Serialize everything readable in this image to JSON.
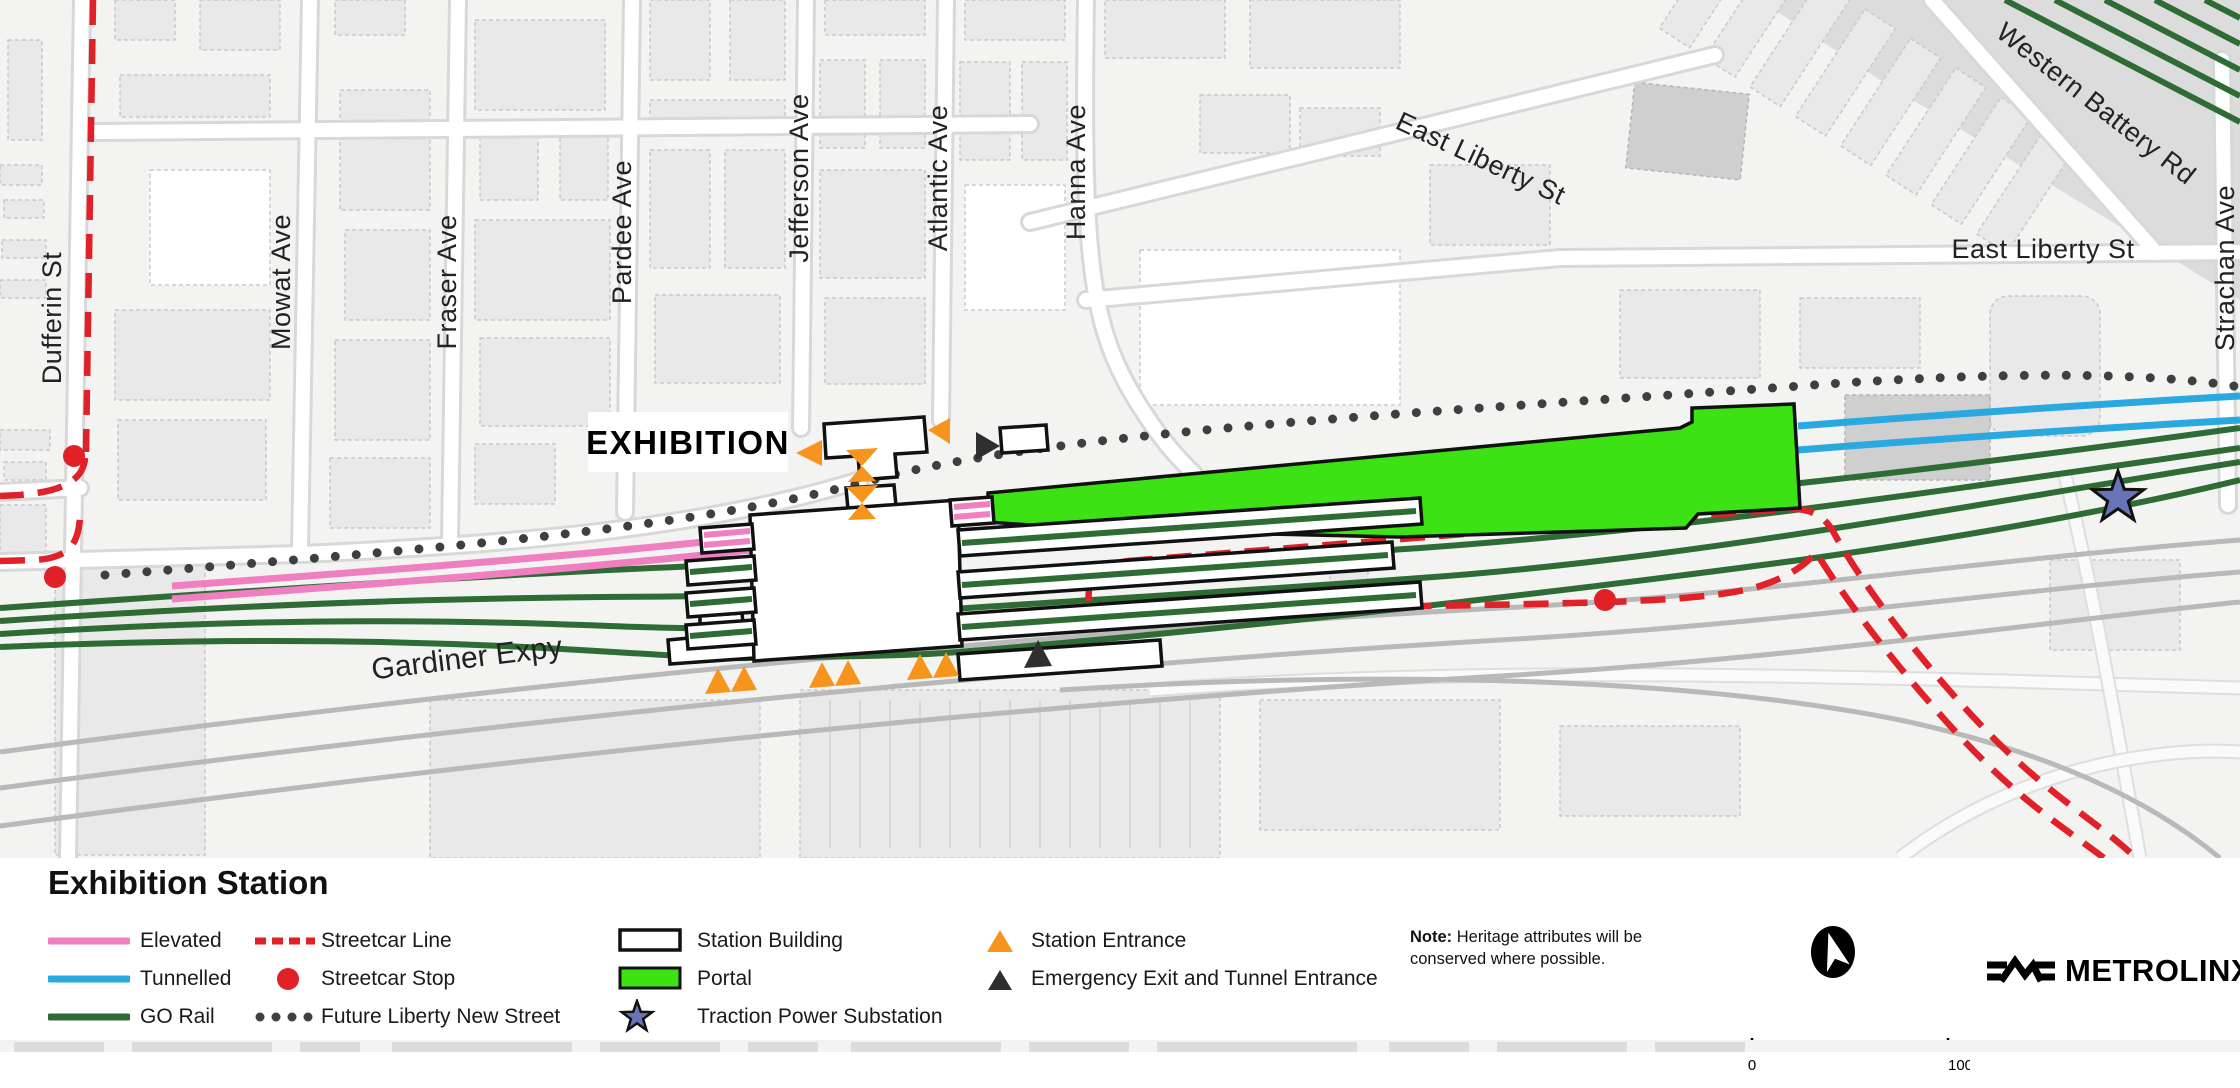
{
  "map": {
    "station_label": "EXHIBITION",
    "streets": [
      "Dufferin St",
      "Mowat Ave",
      "Fraser Ave",
      "Pardee Ave",
      "Jefferson Ave",
      "Atlantic Ave",
      "Hanna Ave",
      "East Liberty St",
      "East Liberty St",
      "Western Battery Rd",
      "Strachan Ave",
      "Gardiner Expy"
    ]
  },
  "legend": {
    "title": "Exhibition Station",
    "columns": [
      {
        "items": [
          {
            "id": "elevated",
            "label": "Elevated"
          },
          {
            "id": "tunnelled",
            "label": "Tunnelled"
          },
          {
            "id": "go-rail",
            "label": "GO Rail"
          }
        ]
      },
      {
        "items": [
          {
            "id": "streetcar-line",
            "label": "Streetcar Line"
          },
          {
            "id": "streetcar-stop",
            "label": "Streetcar Stop"
          },
          {
            "id": "future-liberty-new-street",
            "label": "Future Liberty New Street"
          }
        ]
      },
      {
        "items": [
          {
            "id": "station-building",
            "label": "Station Building"
          },
          {
            "id": "portal",
            "label": "Portal"
          },
          {
            "id": "traction-power-substation",
            "label": "Traction Power Substation"
          }
        ]
      },
      {
        "items": [
          {
            "id": "station-entrance",
            "label": "Station Entrance"
          },
          {
            "id": "emergency-exit",
            "label": "Emergency Exit and Tunnel Entrance"
          }
        ]
      }
    ],
    "note_label": "Note:",
    "note_text": "Heritage attributes will be conserved where possible.",
    "scale_start": "0",
    "scale_end": "100 metres",
    "logo_text": "METROLINX"
  },
  "colors": {
    "elevated": "#f07fc1",
    "tunnelled": "#2aa9e0",
    "go_rail": "#2e6b35",
    "streetcar": "#e02127",
    "portal": "#3ce214",
    "substation": "#6874b8",
    "entrance": "#f7941e",
    "emergency": "#2f2f2f",
    "future_street": "#3f3f3f"
  }
}
